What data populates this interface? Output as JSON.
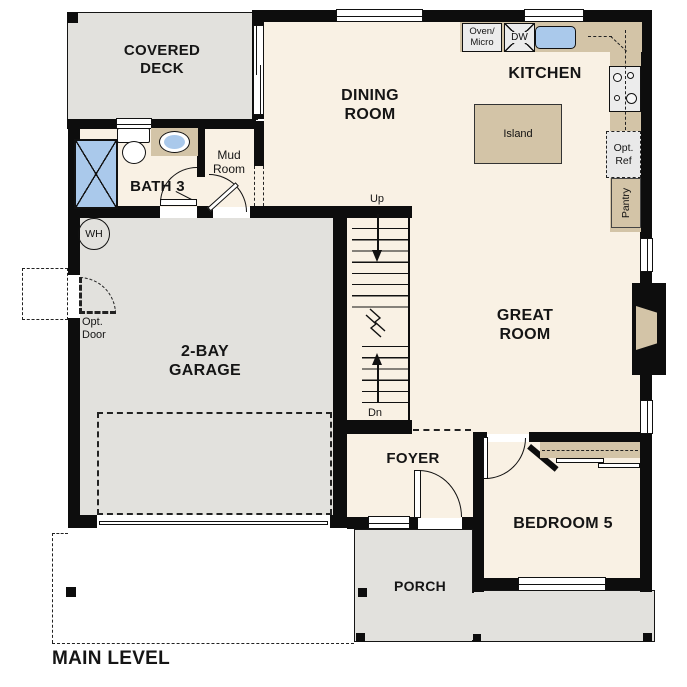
{
  "title": {
    "label": "MAIN LEVEL"
  },
  "rooms": {
    "covered_deck": {
      "label": "COVERED\nDECK"
    },
    "bath3": {
      "label": "BATH 3"
    },
    "mud_room": {
      "label": "Mud\nRoom"
    },
    "dining_room": {
      "label": "DINING\nROOM"
    },
    "kitchen": {
      "label": "KITCHEN"
    },
    "garage": {
      "label": "2-BAY\nGARAGE"
    },
    "great_room": {
      "label": "GREAT\nROOM"
    },
    "foyer": {
      "label": "FOYER"
    },
    "bedroom5": {
      "label": "BEDROOM 5"
    },
    "porch": {
      "label": "PORCH"
    }
  },
  "fixtures": {
    "oven_micro": {
      "label": "Oven/\nMicro"
    },
    "dishwasher": {
      "label": "DW"
    },
    "island": {
      "label": "Island"
    },
    "opt_ref": {
      "label": "Opt.\nRef"
    },
    "pantry": {
      "label": "Pantry"
    },
    "water_heater": {
      "label": "WH"
    },
    "opt_door": {
      "label": "Opt.\nDoor"
    }
  },
  "stairs": {
    "up": "Up",
    "down": "Dn"
  },
  "colors": {
    "floor": "#f9f1e4",
    "outdoor": "#e2e1dd",
    "counter": "#d3c4a7",
    "blue": "#aac9eb",
    "appliance": "#ececec",
    "wall": "#0d0d0d"
  }
}
